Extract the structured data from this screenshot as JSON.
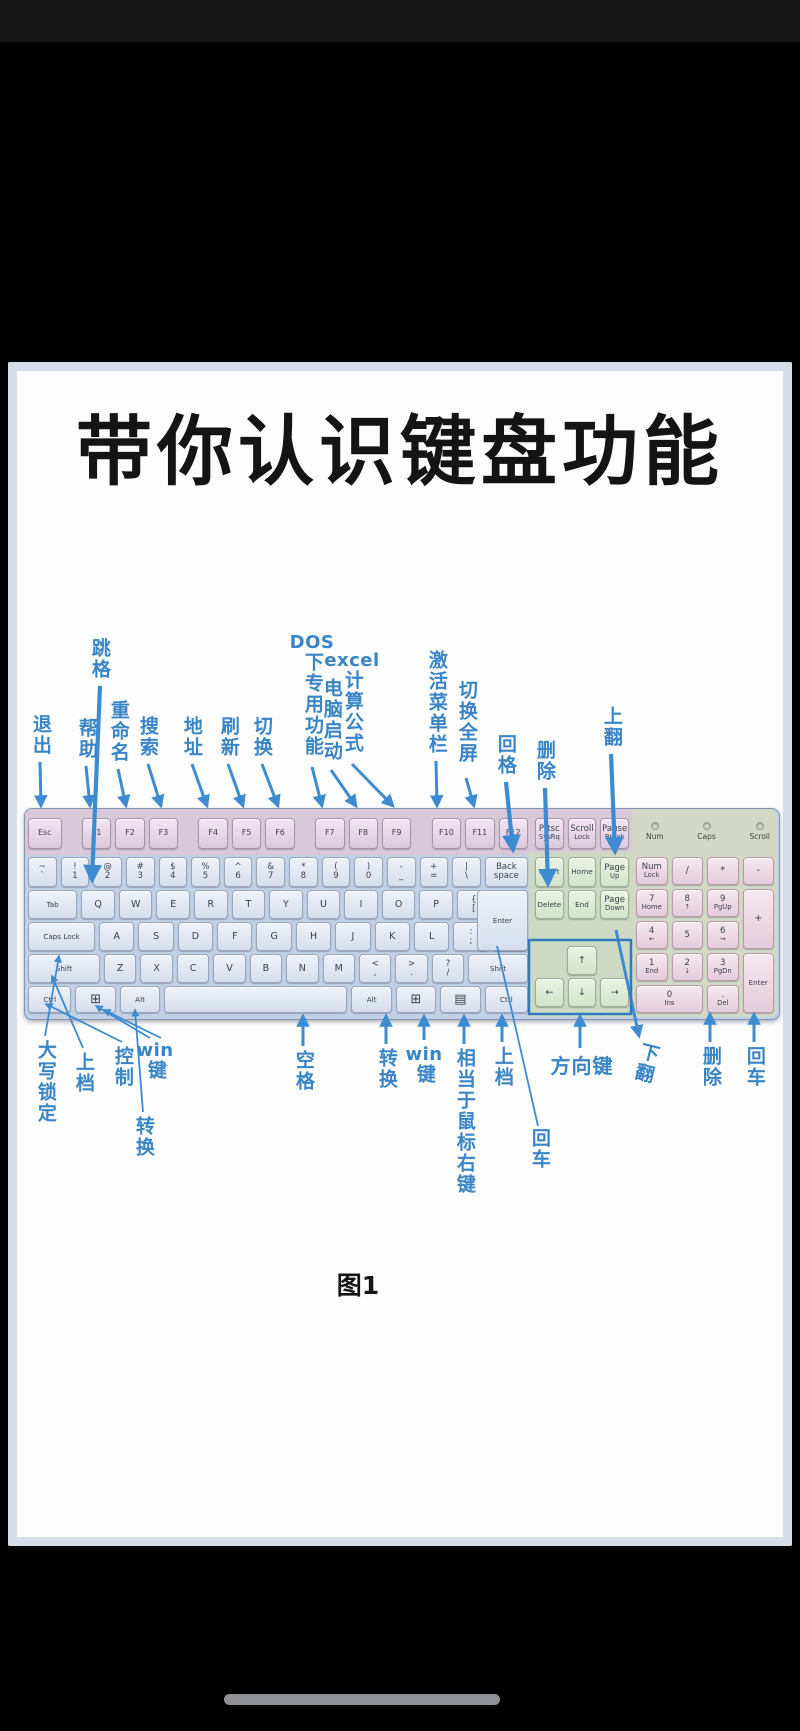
{
  "page": {
    "title": "带你认识键盘功能",
    "caption": "图1"
  },
  "colors": {
    "callout_blue": "#3a85c6",
    "function_key": "#dcc8dc",
    "main_key": "#d6deee",
    "nav_key": "#d4e4c8",
    "numpad_key": "#e4ccda",
    "keyboard_body": "#c2d1e6"
  },
  "callouts_top": {
    "tab": {
      "text": "跳格"
    },
    "esc": {
      "text": "退出"
    },
    "f1": {
      "text": "帮助"
    },
    "f2": {
      "text": "重命名"
    },
    "f3": {
      "text": "搜索"
    },
    "f4": {
      "text": "地址"
    },
    "f5": {
      "text": "刷新"
    },
    "f6": {
      "text": "切换"
    },
    "f7": {
      "pre": "DOS",
      "text": "下专用功能"
    },
    "f8": {
      "text": "电脑启动"
    },
    "f9": {
      "pre": "excel",
      "text": "计算公式"
    },
    "f10": {
      "text": "激活菜单栏"
    },
    "f11": {
      "text": "切换全屏"
    },
    "backspace": {
      "text": "回格"
    },
    "delete": {
      "text": "删除"
    },
    "pageup": {
      "text": "上翻"
    }
  },
  "callouts_bottom": {
    "capslock": {
      "text": "大写锁定"
    },
    "shift_left": {
      "text": "上档"
    },
    "ctrl_left": {
      "text": "控制"
    },
    "win_left": {
      "pre": "win",
      "text": "键"
    },
    "alt_left": {
      "text": "转换"
    },
    "space": {
      "text": "空格"
    },
    "alt_right": {
      "text": "转换"
    },
    "win_right": {
      "pre": "win",
      "text": "键"
    },
    "menu": {
      "text": "相当于鼠标右键"
    },
    "shift_right": {
      "text": "上档"
    },
    "enter": {
      "text": "回车"
    },
    "arrow_keys": {
      "text": "方向键"
    },
    "pagedown": {
      "text": "下翻"
    },
    "num_delete": {
      "text": "删除"
    },
    "num_enter": {
      "text": "回车"
    }
  },
  "keyboard": {
    "indicators": [
      "Num",
      "Caps",
      "Scroll"
    ],
    "fn_row": [
      {
        "id": "esc",
        "t": "Esc",
        "w": 1.15,
        "c": "fn"
      },
      {
        "g": 0.45
      },
      {
        "id": "f1",
        "t": "F1",
        "c": "fn"
      },
      {
        "id": "f2",
        "t": "F2",
        "c": "fn"
      },
      {
        "id": "f3",
        "t": "F3",
        "c": "fn"
      },
      {
        "g": 0.45
      },
      {
        "id": "f4",
        "t": "F4",
        "c": "fn"
      },
      {
        "id": "f5",
        "t": "F5",
        "c": "fn"
      },
      {
        "id": "f6",
        "t": "F6",
        "c": "fn"
      },
      {
        "g": 0.45
      },
      {
        "id": "f7",
        "t": "F7",
        "c": "fn"
      },
      {
        "id": "f8",
        "t": "F8",
        "c": "fn"
      },
      {
        "id": "f9",
        "t": "F9",
        "c": "fn"
      },
      {
        "g": 0.45
      },
      {
        "id": "f10",
        "t": "F10",
        "c": "fn"
      },
      {
        "id": "f11",
        "t": "F11",
        "c": "fn"
      },
      {
        "id": "f12",
        "t": "F12",
        "c": "fn"
      }
    ],
    "num_row": [
      {
        "id": "grave",
        "t": "~",
        "b": "`",
        "c": "main two"
      },
      {
        "id": "1",
        "t": "!",
        "b": "1",
        "c": "main two"
      },
      {
        "id": "2",
        "t": "@",
        "b": "2",
        "c": "main two"
      },
      {
        "id": "3",
        "t": "#",
        "b": "3",
        "c": "main two"
      },
      {
        "id": "4",
        "t": "$",
        "b": "4",
        "c": "main two"
      },
      {
        "id": "5",
        "t": "%",
        "b": "5",
        "c": "main two"
      },
      {
        "id": "6",
        "t": "^",
        "b": "6",
        "c": "main two"
      },
      {
        "id": "7",
        "t": "&",
        "b": "7",
        "c": "main two"
      },
      {
        "id": "8",
        "t": "*",
        "b": "8",
        "c": "main two"
      },
      {
        "id": "9",
        "t": "(",
        "b": "9",
        "c": "main two"
      },
      {
        "id": "0",
        "t": ")",
        "b": "0",
        "c": "main two"
      },
      {
        "id": "minus",
        "t": "-",
        "b": "_",
        "c": "main two"
      },
      {
        "id": "plus",
        "t": "+",
        "b": "=",
        "c": "main two"
      },
      {
        "id": "backslash",
        "t": "|",
        "b": "\\",
        "c": "main two"
      },
      {
        "id": "backspace",
        "t": "Back",
        "b": "space",
        "w": 1.55,
        "c": "main two tiny1"
      }
    ],
    "qwerty_row": [
      {
        "id": "tab",
        "t": "Tab",
        "w": 1.5,
        "c": "main tiny1"
      },
      {
        "id": "q",
        "t": "Q",
        "c": "main"
      },
      {
        "id": "w",
        "t": "W",
        "c": "main"
      },
      {
        "id": "e",
        "t": "E",
        "c": "main"
      },
      {
        "id": "r",
        "t": "R",
        "c": "main"
      },
      {
        "id": "t",
        "t": "T",
        "c": "main"
      },
      {
        "id": "y",
        "t": "Y",
        "c": "main"
      },
      {
        "id": "u",
        "t": "U",
        "c": "main"
      },
      {
        "id": "i",
        "t": "I",
        "c": "main"
      },
      {
        "id": "o",
        "t": "O",
        "c": "main"
      },
      {
        "id": "p",
        "t": "P",
        "c": "main"
      },
      {
        "id": "bracketleft",
        "t": "{",
        "b": "[",
        "c": "main two"
      },
      {
        "id": "bracketright",
        "t": "}",
        "b": "]",
        "c": "main two"
      }
    ],
    "caps_row": [
      {
        "id": "capslock",
        "t": "Caps Lock",
        "w": 1.95,
        "c": "main tiny1"
      },
      {
        "id": "a",
        "t": "A",
        "c": "main"
      },
      {
        "id": "s",
        "t": "S",
        "c": "main"
      },
      {
        "id": "d",
        "t": "D",
        "c": "main"
      },
      {
        "id": "f",
        "t": "F",
        "c": "main"
      },
      {
        "id": "g",
        "t": "G",
        "c": "main"
      },
      {
        "id": "h",
        "t": "H",
        "c": "main"
      },
      {
        "id": "j",
        "t": "J",
        "c": "main"
      },
      {
        "id": "k",
        "t": "K",
        "c": "main"
      },
      {
        "id": "l",
        "t": "L",
        "c": "main"
      },
      {
        "id": "semicolon",
        "t": ":",
        "b": ";",
        "c": "main two"
      },
      {
        "id": "quote",
        "t": "\"",
        "b": "'",
        "c": "main two"
      }
    ],
    "shift_row": [
      {
        "id": "shift-left",
        "t": "Shift",
        "w": 2.3,
        "c": "main tiny1"
      },
      {
        "id": "z",
        "t": "Z",
        "c": "main"
      },
      {
        "id": "x",
        "t": "X",
        "c": "main"
      },
      {
        "id": "c",
        "t": "C",
        "c": "main"
      },
      {
        "id": "v",
        "t": "V",
        "c": "main"
      },
      {
        "id": "b",
        "t": "B",
        "c": "main"
      },
      {
        "id": "n",
        "t": "N",
        "c": "main"
      },
      {
        "id": "m",
        "t": "M",
        "c": "main"
      },
      {
        "id": "comma",
        "t": "<",
        "b": ",",
        "c": "main two"
      },
      {
        "id": "period",
        "t": ">",
        "b": ".",
        "c": "main two"
      },
      {
        "id": "slash",
        "t": "?",
        "b": "/",
        "c": "main two"
      },
      {
        "id": "shift-right",
        "t": "Shift",
        "w": 1.9,
        "c": "main tiny1"
      }
    ],
    "bottom_row": [
      {
        "id": "ctrl-left",
        "t": "Ctrl",
        "w": 1.35,
        "c": "main tiny1"
      },
      {
        "id": "win-left",
        "t": "⊞",
        "w": 1.25,
        "c": "main winkey"
      },
      {
        "id": "alt-left",
        "t": "Alt",
        "w": 1.25,
        "c": "main tiny1"
      },
      {
        "id": "space",
        "t": "",
        "w": 5.9,
        "c": "main"
      },
      {
        "id": "alt-right",
        "t": "Alt",
        "w": 1.25,
        "c": "main tiny1"
      },
      {
        "id": "win-right",
        "t": "⊞",
        "w": 1.25,
        "c": "main winkey"
      },
      {
        "id": "menu",
        "t": "▤",
        "w": 1.25,
        "c": "main winkey"
      },
      {
        "id": "ctrl-right",
        "t": "Ctrl",
        "w": 1.35,
        "c": "main tiny1"
      }
    ],
    "enter_main": [
      {
        "id": "enter",
        "t": "Enter",
        "c": "main tiny1"
      }
    ],
    "nav_r1": [
      {
        "id": "prtsc",
        "t": "Prtsc",
        "b": "SysRq",
        "c": "fn two tiny"
      },
      {
        "id": "scroll-lock",
        "t": "Scroll",
        "b": "Lock",
        "c": "fn two tiny"
      },
      {
        "id": "pause",
        "t": "Pause",
        "b": "Break",
        "c": "fn two tiny"
      }
    ],
    "nav_r2": [
      {
        "id": "insert",
        "t": "Insert",
        "c": "nav tiny1"
      },
      {
        "id": "home",
        "t": "Home",
        "c": "nav tiny1"
      },
      {
        "id": "pageup",
        "t": "Page",
        "b": "Up",
        "c": "nav two tiny"
      }
    ],
    "nav_r3": [
      {
        "id": "delete",
        "t": "Delete",
        "c": "nav tiny1"
      },
      {
        "id": "end",
        "t": "End",
        "c": "nav tiny1"
      },
      {
        "id": "pagedown",
        "t": "Page",
        "b": "Down",
        "c": "nav two tiny"
      }
    ],
    "arrows_up": [
      {
        "g": 1
      },
      {
        "id": "arrow-up",
        "t": "↑",
        "c": "nav"
      },
      {
        "g": 1
      }
    ],
    "arrows_low": [
      {
        "id": "arrow-left",
        "t": "←",
        "c": "nav"
      },
      {
        "id": "arrow-down",
        "t": "↓",
        "c": "nav"
      },
      {
        "id": "arrow-right",
        "t": "→",
        "c": "nav"
      }
    ],
    "numpad": [
      {
        "id": "numlock",
        "t": "Num",
        "b": "Lock",
        "c": "np two tiny"
      },
      {
        "id": "np-divide",
        "t": "/",
        "c": "np"
      },
      {
        "id": "np-multiply",
        "t": "*",
        "c": "np"
      },
      {
        "id": "np-minus",
        "t": "-",
        "c": "np"
      },
      {
        "id": "np7",
        "t": "7",
        "b": "Home",
        "c": "np two tiny"
      },
      {
        "id": "np8",
        "t": "8",
        "b": "↑",
        "c": "np two tiny"
      },
      {
        "id": "np9",
        "t": "9",
        "b": "PgUp",
        "c": "np two tiny"
      },
      {
        "id": "np-plus",
        "t": "+",
        "c": "np",
        "rs": 2
      },
      {
        "id": "np4",
        "t": "4",
        "b": "←",
        "c": "np two tiny"
      },
      {
        "id": "np5",
        "t": "5",
        "c": "np two tiny"
      },
      {
        "id": "np6",
        "t": "6",
        "b": "→",
        "c": "np two tiny"
      },
      {
        "id": "np1",
        "t": "1",
        "b": "End",
        "c": "np two tiny"
      },
      {
        "id": "np2",
        "t": "2",
        "b": "↓",
        "c": "np two tiny"
      },
      {
        "id": "np3",
        "t": "3",
        "b": "PgDn",
        "c": "np two tiny"
      },
      {
        "id": "np-enter",
        "t": "Enter",
        "c": "np tiny1",
        "rs": 2
      },
      {
        "id": "np0",
        "t": "0",
        "b": "Ins",
        "c": "np two tiny",
        "cs": 2
      },
      {
        "id": "np-dot",
        "t": ".",
        "b": "Del",
        "c": "np two tiny"
      }
    ]
  }
}
